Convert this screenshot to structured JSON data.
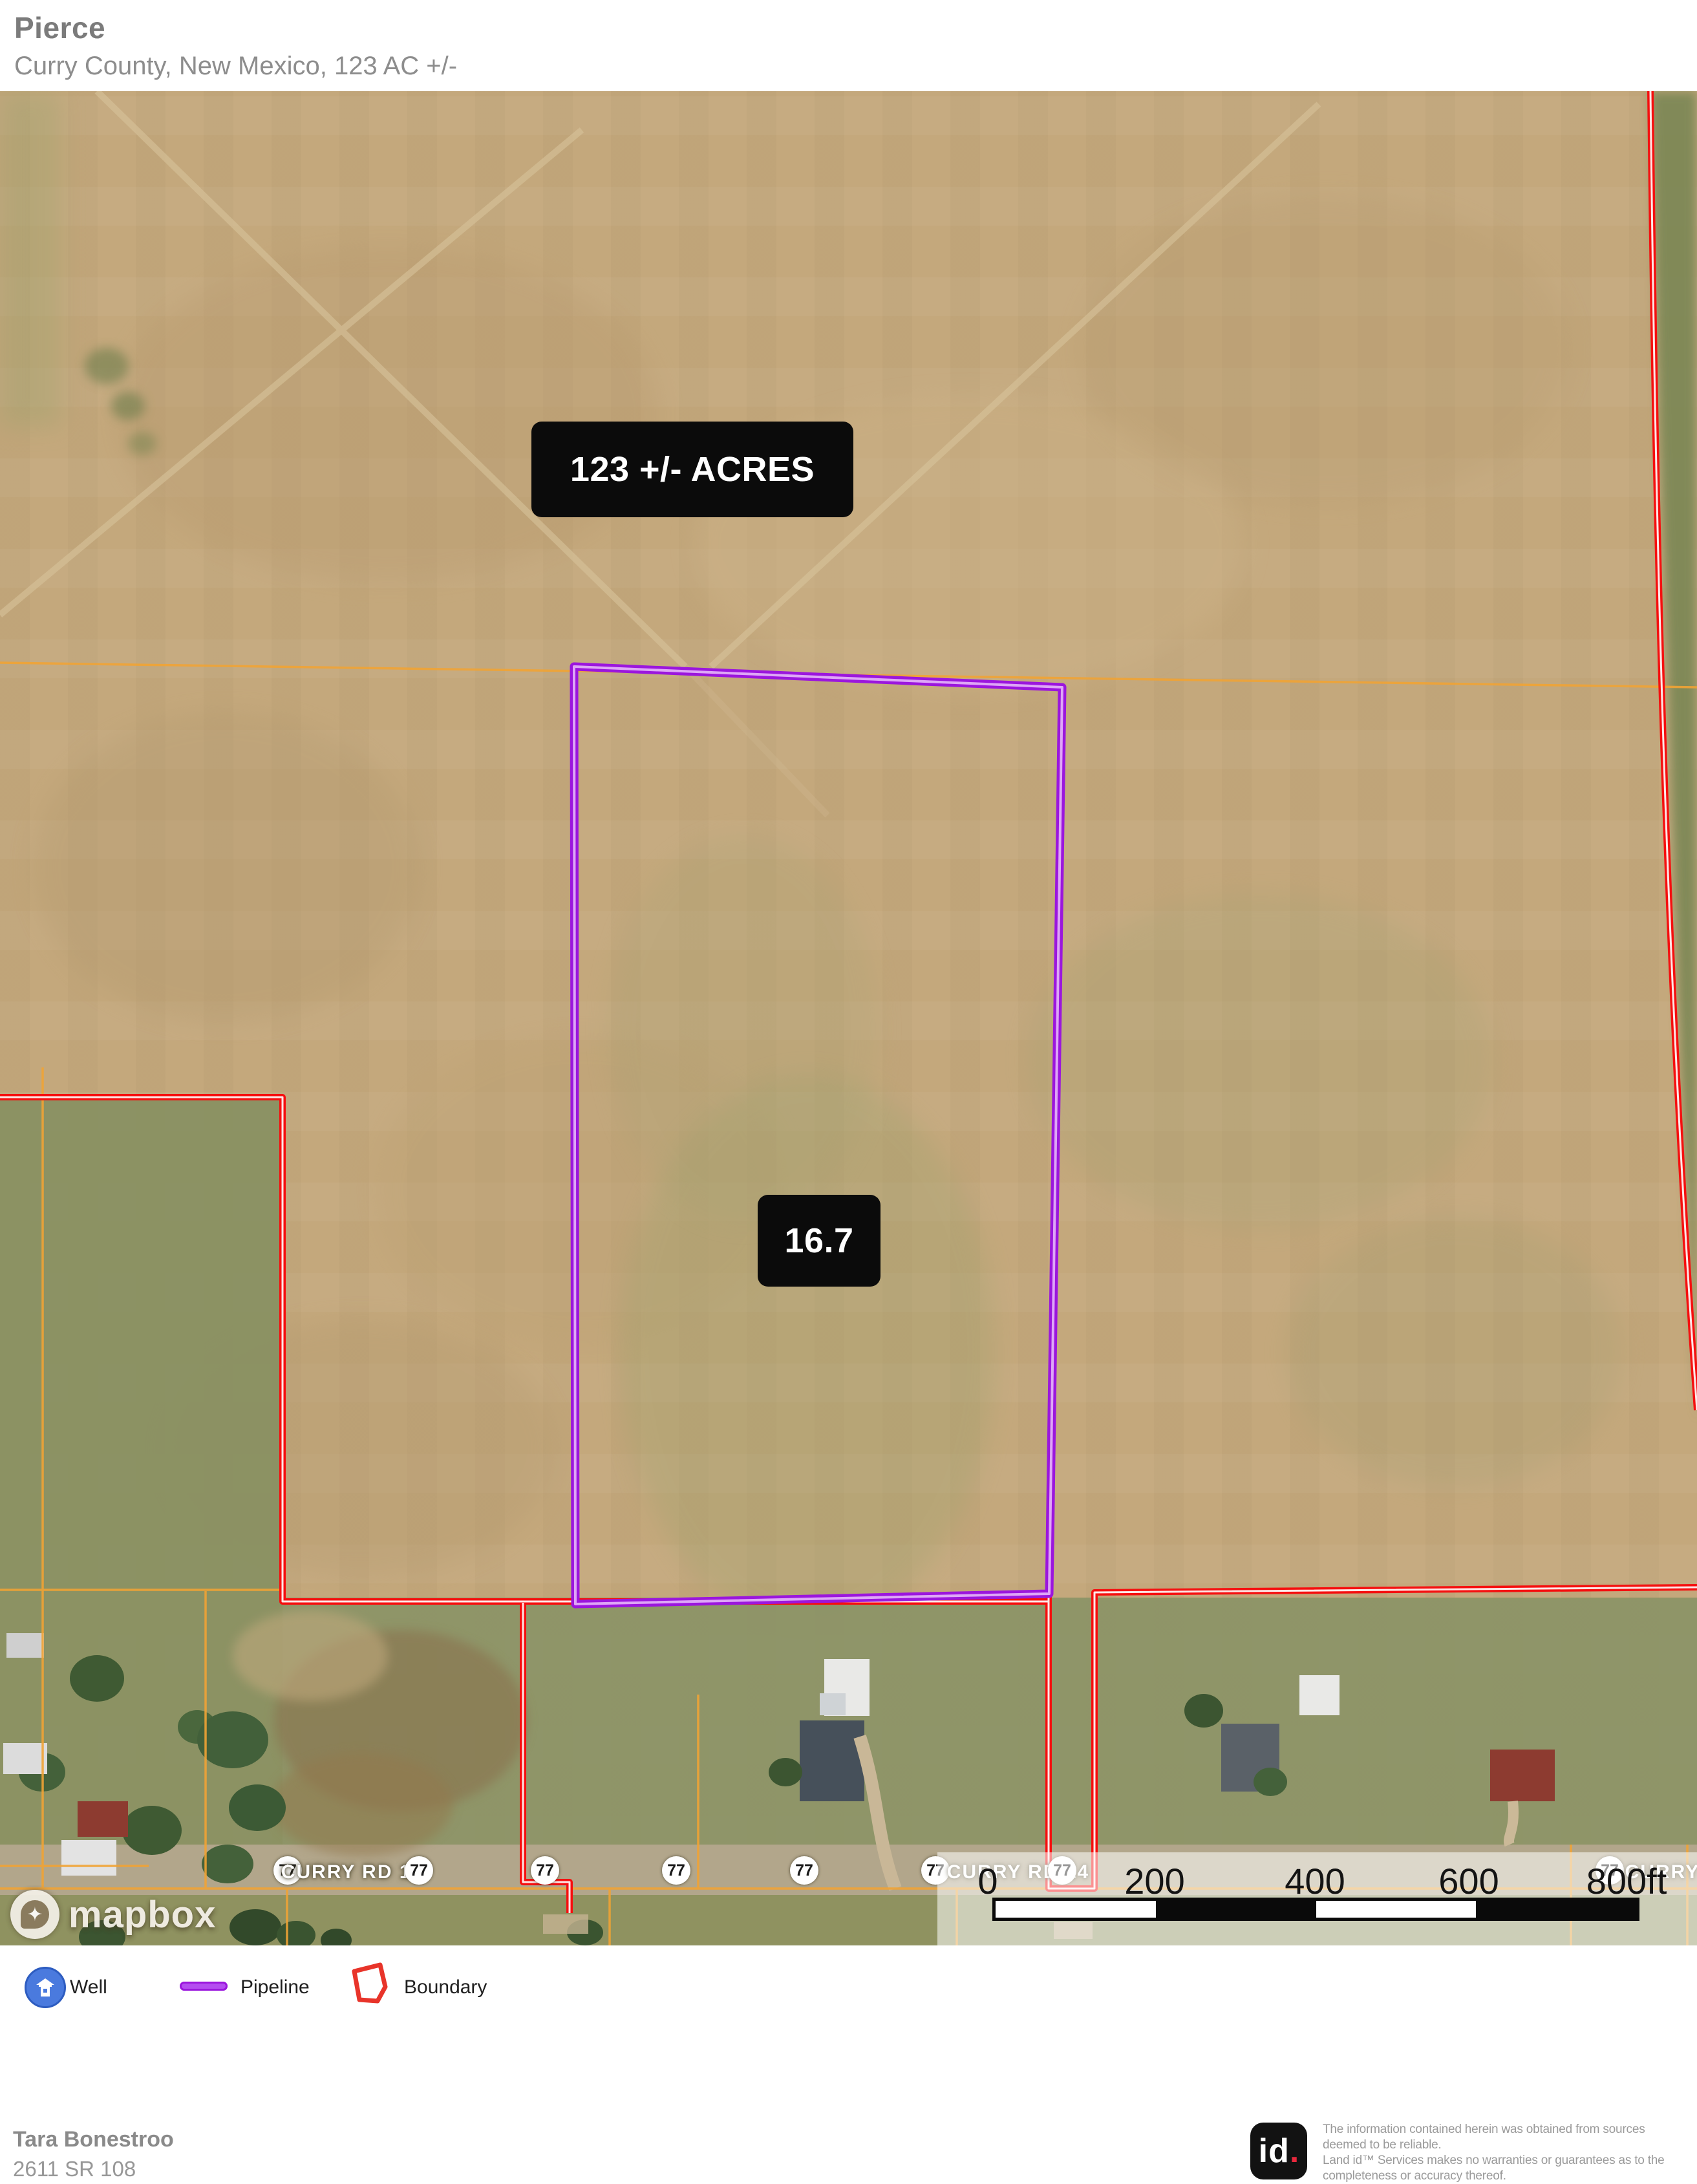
{
  "header": {
    "title": "Pierce",
    "subtitle": "Curry County, New Mexico, 123 AC +/-"
  },
  "map": {
    "area_label": "123 +/- ACRES",
    "subarea_label": "16.7",
    "road_label": "CURRY RD 14",
    "road_label_right": "CURRY RD",
    "route_shield": "77",
    "attribution": "mapbox",
    "scale": {
      "ticks": [
        "0",
        "200",
        "400",
        "600",
        "800ft"
      ]
    }
  },
  "legend": {
    "items": [
      {
        "label": "Well"
      },
      {
        "label": "Pipeline"
      },
      {
        "label": "Boundary"
      }
    ]
  },
  "footer": {
    "contact_name": "Tara Bonestroo",
    "contact_address": "2611 SR 108",
    "logo_text": "id",
    "logo_dot": ".",
    "disclaimer_lines": [
      "The information contained herein was obtained from sources",
      "deemed to be reliable.",
      " Land id™ Services makes no warranties or guarantees as to the",
      "completeness or accuracy thereof."
    ]
  },
  "colors": {
    "boundary": "#f50f0f",
    "pipeline": "#9b16dd",
    "parcel_line": "#f0a335",
    "terrain": "#c4a87c",
    "label_box": "#0b0b0b"
  }
}
